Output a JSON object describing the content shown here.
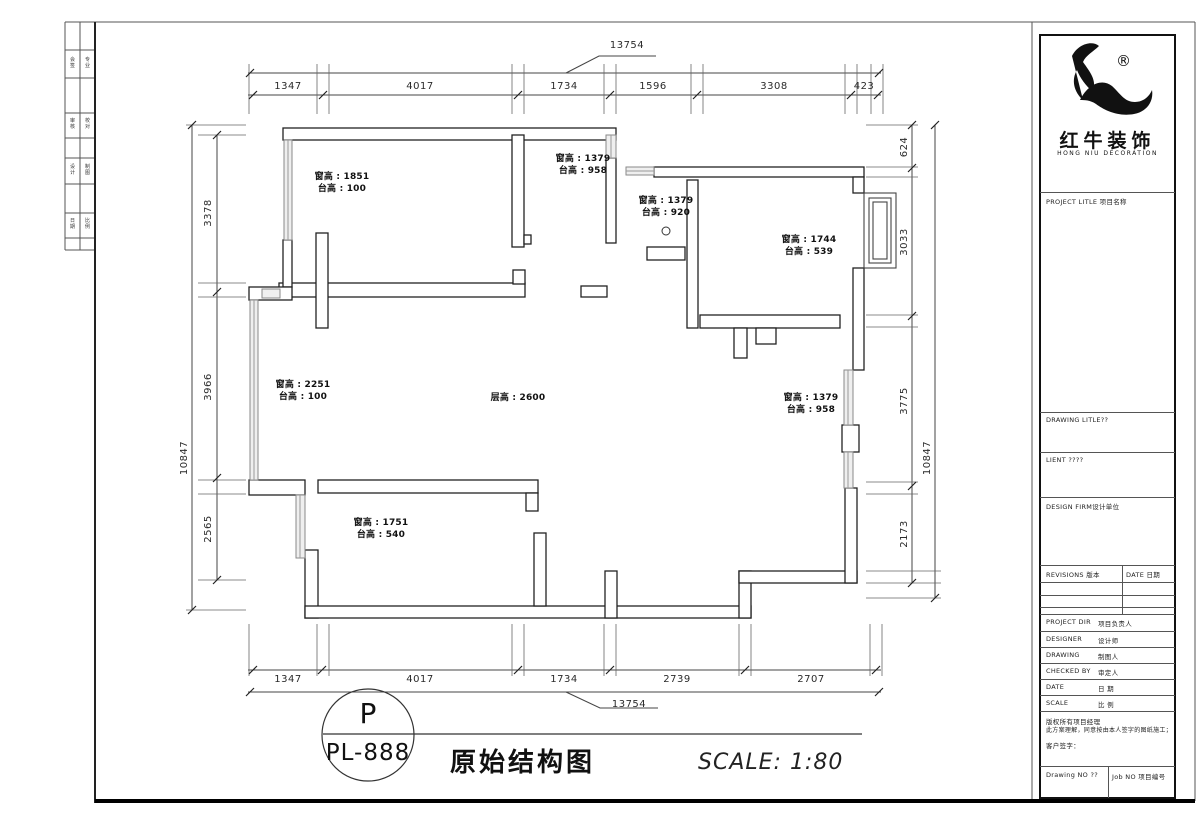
{
  "dims": {
    "top": {
      "overall": "13754",
      "segments": [
        "1347",
        "4017",
        "1734",
        "1596",
        "3308",
        "423"
      ]
    },
    "bottom": {
      "overall": "13754",
      "segments": [
        "1347",
        "4017",
        "1734",
        "2739",
        "2707"
      ]
    },
    "left": {
      "overall": "10847",
      "segments": [
        "3378",
        "3966",
        "2565"
      ]
    },
    "right": {
      "overall": "10847",
      "segments": [
        "624",
        "3033",
        "3775",
        "2173"
      ]
    }
  },
  "annotations": {
    "a1": {
      "l1": "窗高 : 1851",
      "l2": "台高 : 100"
    },
    "a2": {
      "l1": "窗高 : 1379",
      "l2": "台高 : 958"
    },
    "a3": {
      "l1": "窗高 : 1379",
      "l2": "台高 : 920"
    },
    "a4": {
      "l1": "窗高 : 1744",
      "l2": "台高 : 539"
    },
    "a5": {
      "l1": "窗高 : 2251",
      "l2": "台高 : 100"
    },
    "a6": {
      "l1": "层高 : 2600"
    },
    "a7": {
      "l1": "窗高 : 1379",
      "l2": "台高 : 958"
    },
    "a8": {
      "l1": "窗高 : 1751",
      "l2": "台高 : 540"
    }
  },
  "title": {
    "bubble_letter": "P",
    "drawing_no": "PL-888",
    "name": "原始结构图",
    "scale": "SCALE:  1:80"
  },
  "brand": {
    "cn": "红牛装饰",
    "en": "HONG NIU DECORATION",
    "reg": "®"
  },
  "titleblock": {
    "project_title": "PROJECT LITLE  项目名称",
    "drawing_title": "DRAWING  LITLE??",
    "client": "LIENT ????",
    "design_firm": "DESIGN  FIRM设计单位",
    "revisions": "REVISIONS  版本",
    "date_col": "DATE  日期",
    "rows": [
      {
        "label": "PROJECT DIR",
        "cn": "项目负责人"
      },
      {
        "label": "DESIGNER",
        "cn": "设计师"
      },
      {
        "label": "DRAWING",
        "cn": "制图人"
      },
      {
        "label": "CHECKED BY",
        "cn": "审定人"
      },
      {
        "label": "DATE",
        "cn": "日 期"
      },
      {
        "label": "SCALE",
        "cn": "比 例"
      }
    ],
    "copyright": {
      "l1": "版权所有项目经理",
      "l2": "此方案理解，同意按由本人签字的图纸施工；",
      "l3": "客户签字："
    },
    "drawing_no": "Drawing NO ??",
    "job_no": "Job NO 项目编号"
  },
  "edge_strip": {
    "rows": [
      {
        "c1": "会签",
        "c2": "专业"
      },
      {
        "c1": "审核",
        "c2": "校对"
      },
      {
        "c1": "设计",
        "c2": "制图"
      },
      {
        "c1": "日期",
        "c2": "比例"
      }
    ]
  }
}
